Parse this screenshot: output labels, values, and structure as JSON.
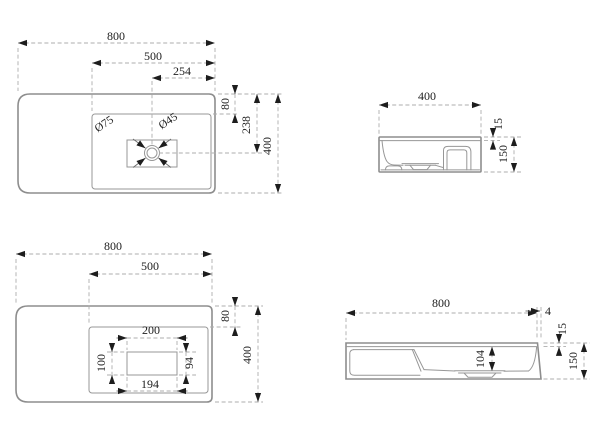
{
  "drawing": {
    "title": "basin technical drawing",
    "background": "#ffffff",
    "line_color": "#8d8d8d",
    "dim_line_color": "#adadad",
    "arrow_color": "#1d1d1d",
    "views": {
      "plan_top": {
        "width": "800",
        "basin_width": "500",
        "drain_offset_x": "254",
        "deck_depth": "80",
        "drain_offset_y": "238",
        "depth": "400",
        "drain_outer_dia": "Ø75",
        "drain_inner_dia": "Ø45"
      },
      "side": {
        "width": "400",
        "rim_thickness": "15",
        "height": "150"
      },
      "plan_bottom": {
        "width": "800",
        "basin_width": "500",
        "deck_depth": "80",
        "depth": "400",
        "cutout_width_top": "200",
        "cutout_width_bottom": "194",
        "cutout_height_left": "100",
        "cutout_height_right": "94"
      },
      "front": {
        "width": "800",
        "edge_taper": "4",
        "rim_thickness": "15",
        "bowl_depth": "104",
        "height": "150"
      }
    }
  }
}
